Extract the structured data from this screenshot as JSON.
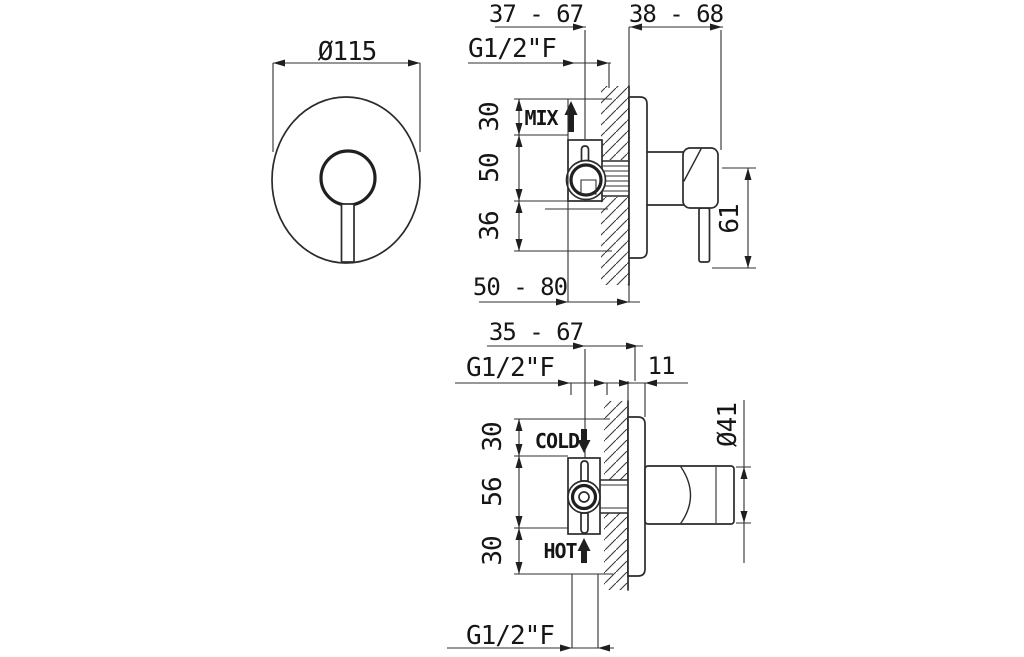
{
  "drawing": {
    "front_view": {
      "diameter": "Ø115"
    },
    "top_view": {
      "dim_depth_range": "37 - 67",
      "dim_wall_range": "38 - 68",
      "thread_label": "G1/2\"F",
      "mix_label": "MIX",
      "dim_top": "30",
      "dim_mid": "50",
      "dim_bottom": "36",
      "dim_body_depth": "50 - 80",
      "dim_lever_length": "61"
    },
    "bottom_view": {
      "dim_depth_range": "35 - 67",
      "thread_label_top": "G1/2\"F",
      "dim_plate_thickness": "11",
      "cold_label": "COLD",
      "hot_label": "HOT",
      "dim_top": "30",
      "dim_mid": "56",
      "dim_bottom": "30",
      "dim_knob_diameter": "Ø41",
      "thread_label_bottom": "G1/2\"F"
    },
    "colors": {
      "line": "#2b2b2b",
      "background": "#ffffff"
    }
  }
}
